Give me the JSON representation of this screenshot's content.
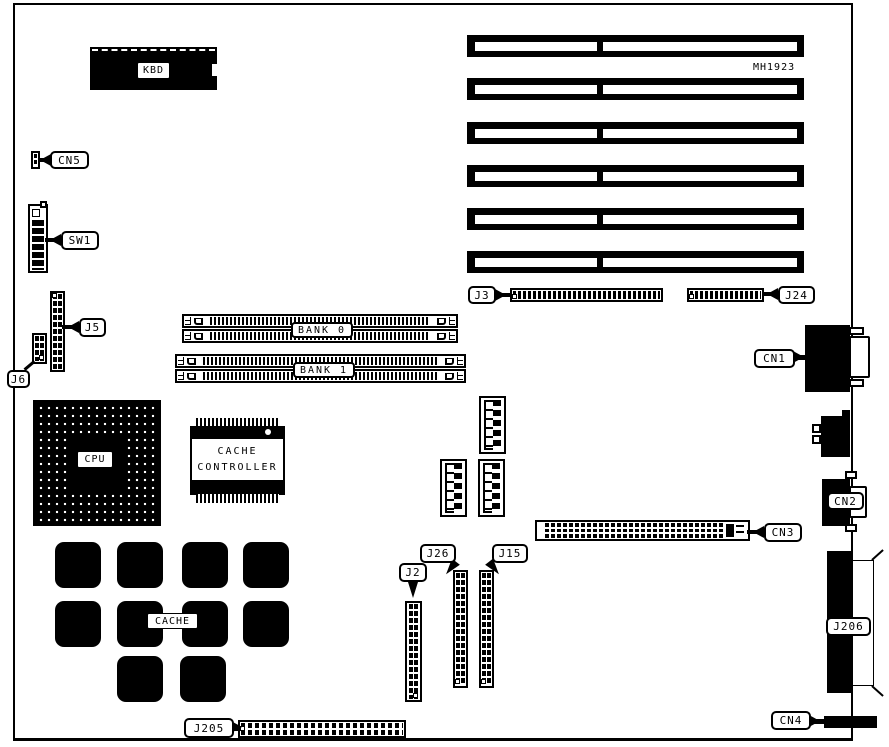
{
  "colors": {
    "ink": "#000000",
    "paper": "#ffffff"
  },
  "board": {
    "part_number": "MH1923"
  },
  "labels": {
    "kbd": "KBD",
    "cn5": "CN5",
    "sw1": "SW1",
    "j5": "J5",
    "j6": "J6",
    "j3": "J3",
    "j24": "J24",
    "bank0": "BANK 0",
    "bank1": "BANK 1",
    "cpu": "CPU",
    "cache": "CACHE",
    "cache_controller_line1": "CACHE",
    "cache_controller_line2": "CONTROLLER",
    "cn1": "CN1",
    "cn2": "CN2",
    "cn3": "CN3",
    "cn4": "CN4",
    "j206": "J206",
    "j205": "J205",
    "j2": "J2",
    "j26": "J26",
    "j15": "J15"
  },
  "components": {
    "expansion_slot_count": 6,
    "cache_chip_count": 10,
    "memory_banks": [
      "BANK 0",
      "BANK 1"
    ]
  }
}
